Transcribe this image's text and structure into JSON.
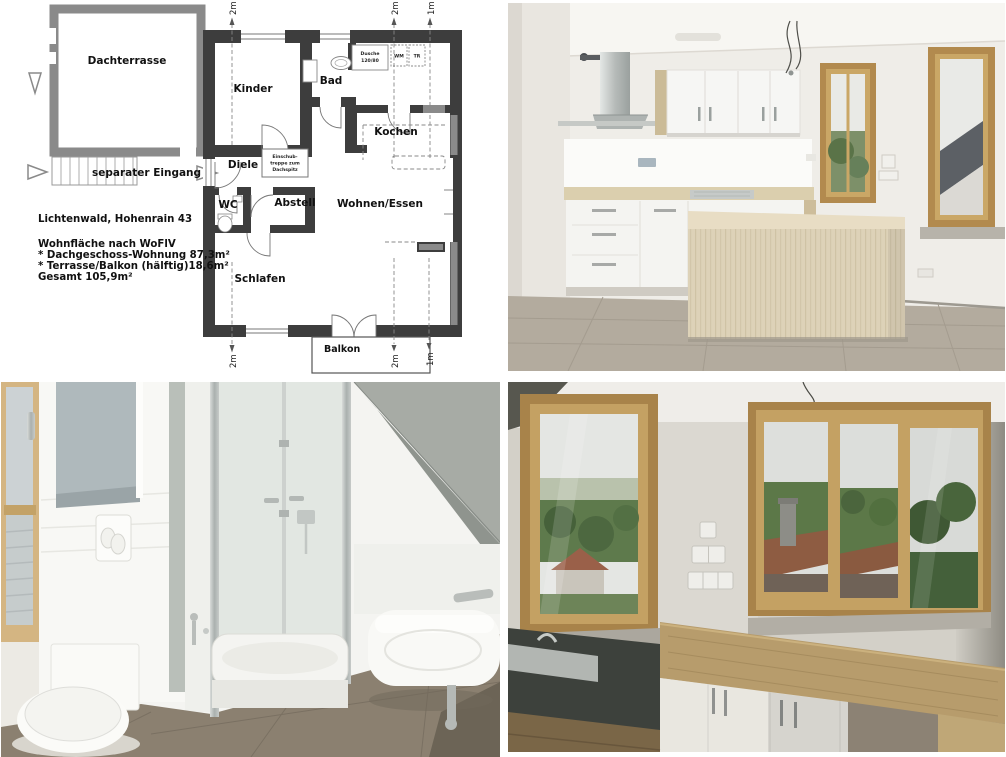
{
  "floor_plan": {
    "address": "Lichtenwald, Hohenrain 43",
    "area_heading": "Wohnfläche nach WoFlV",
    "area_line1": "* Dachgeschoss-Wohnung 87,3m²",
    "area_line2": "* Terrasse/Balkon (hälftig)18,6m²",
    "area_total": "Gesamt 105,9m²",
    "rooms": {
      "roof_terrace": "Dachterrasse",
      "kids_room": "Kinder",
      "bathroom": "Bad",
      "kitchen": "Kochen",
      "hallway": "Diele",
      "separate_entrance": "separater Eingang",
      "wc": "WC",
      "storage": "Abstell",
      "living_dining": "Wohnen/Essen",
      "bedroom": "Schlafen",
      "balcony": "Balkon"
    },
    "labels": {
      "shower_line1": "Dusche",
      "shower_line2": "120/80",
      "washing_machine": "WM",
      "dryer": "TR",
      "attic_stairs_line1": "Einschub-",
      "attic_stairs_line2": "treppe zum",
      "attic_stairs_line3": "Dachspitz"
    },
    "dimensions": {
      "two_m": "2m",
      "one_m": "1m"
    },
    "colors": {
      "wall": "#3d3d3d",
      "terrace_wall": "#8a8a8a",
      "window_gray": "#8a8a8a",
      "annotation": "#777777"
    }
  },
  "photos": {
    "colors": {
      "wood_frame": "#b28a4e",
      "cabinet_white": "#f5f5f2",
      "island_wood": "#ded3ba",
      "floor_tile": "#b3ab9e",
      "bath_floor": "#8b8070",
      "foliage_green": "#5d7a4c",
      "roof_red": "#8e5c42"
    }
  }
}
